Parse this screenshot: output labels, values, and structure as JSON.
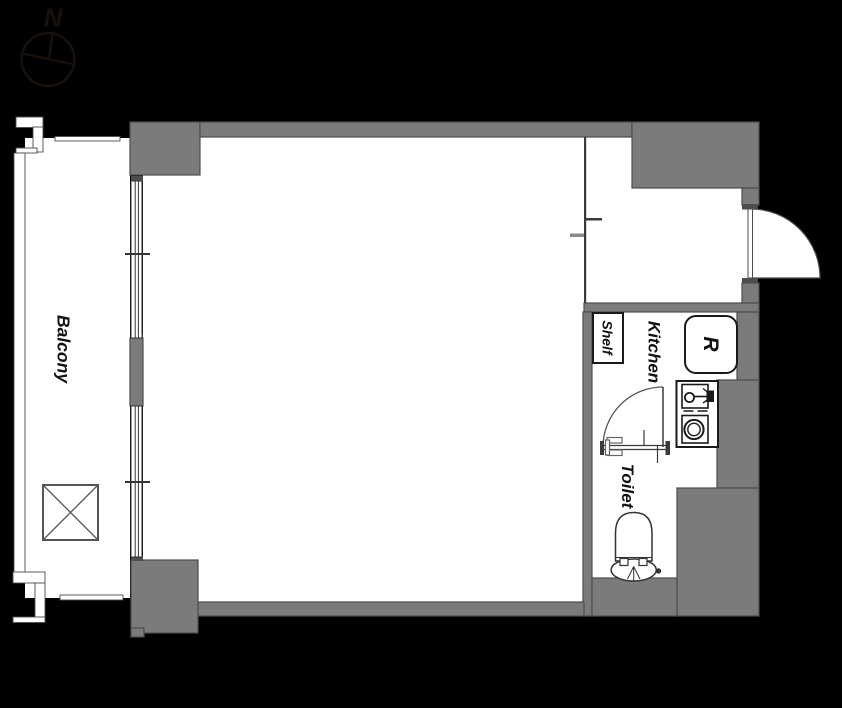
{
  "labels": {
    "compass_north": "N",
    "balcony": "Balcony",
    "shelf": "Shelf",
    "kitchen": "Kitchen",
    "refrigerator": "R",
    "toilet": "Toilet"
  },
  "colors": {
    "background": "#000000",
    "wall_fill": "#7b7b7b",
    "wall_outline": "#4d4d4d",
    "floor": "#ffffff",
    "fixture_line": "#1a1a1a",
    "thin_line": "#3a3a3a",
    "label_text": "#111111",
    "compass": "#17100b"
  }
}
